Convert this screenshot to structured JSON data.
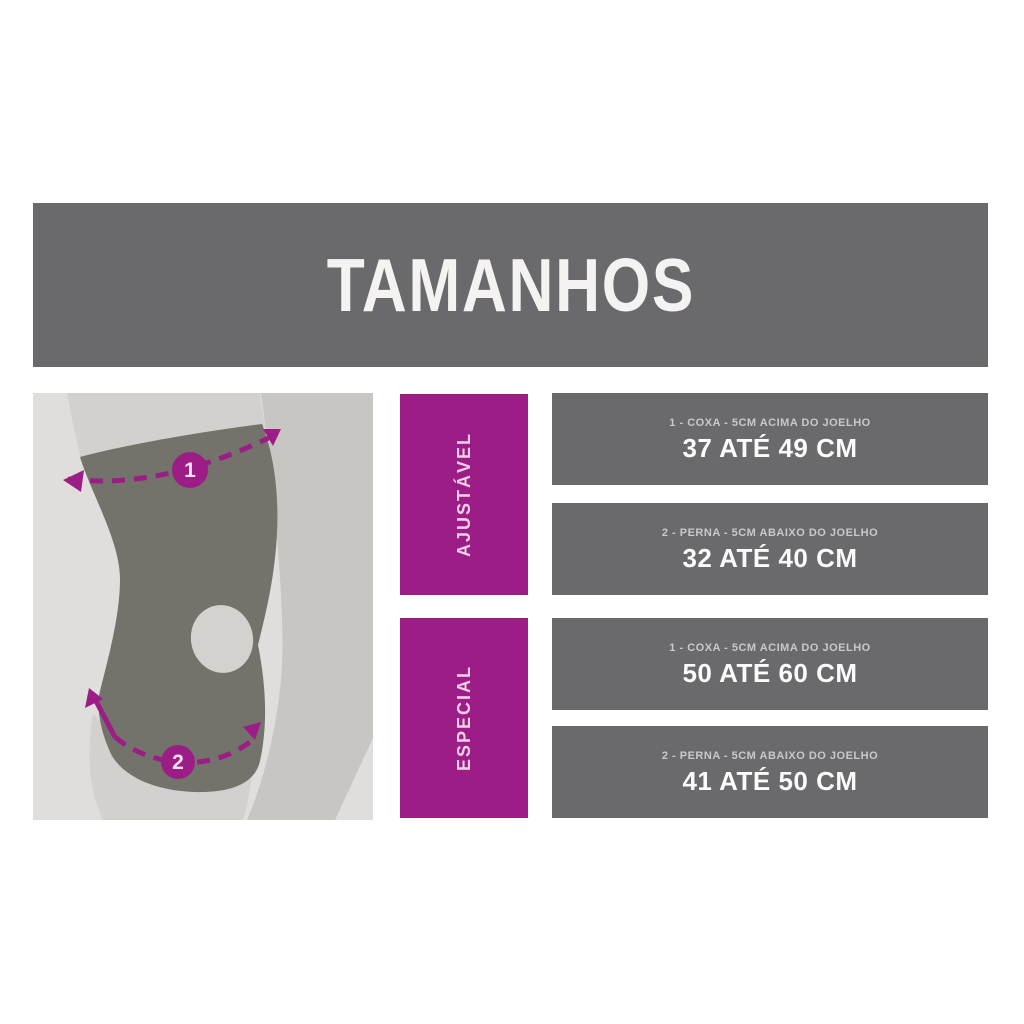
{
  "header": {
    "title": "TAMANHOS"
  },
  "colors": {
    "banner_gray": "#6a696b",
    "bar_gray": "#6a696b",
    "accent_purple": "#9c1d86",
    "panel_background": "#dfdedc",
    "front_leg": "#d2d1cd",
    "back_leg": "#c7c6c2",
    "brace": "#73726b",
    "patella_opening": "#d3d2ce",
    "title_text": "#f4f3f1",
    "caption_text": "#c9c8ca",
    "value_text": "#fbfbfb",
    "group_label_text": "#f2cfe8"
  },
  "size_groups": [
    {
      "label": "AJUSTÁVEL",
      "rows": [
        {
          "caption": "1 - COXA - 5CM ACIMA DO JOELHO",
          "value": "37 ATÉ 49 CM"
        },
        {
          "caption": "2 - PERNA - 5CM ABAIXO DO JOELHO",
          "value": "32 ATÉ 40 CM"
        }
      ]
    },
    {
      "label": "ESPECIAL",
      "rows": [
        {
          "caption": "1 - COXA - 5CM ACIMA DO JOELHO",
          "value": "50 ATÉ 60 CM"
        },
        {
          "caption": "2 - PERNA - 5CM ABAIXO DO JOELHO",
          "value": "41 ATÉ 50 CM"
        }
      ]
    }
  ],
  "diagram": {
    "marker_1": "1",
    "marker_2": "2"
  }
}
